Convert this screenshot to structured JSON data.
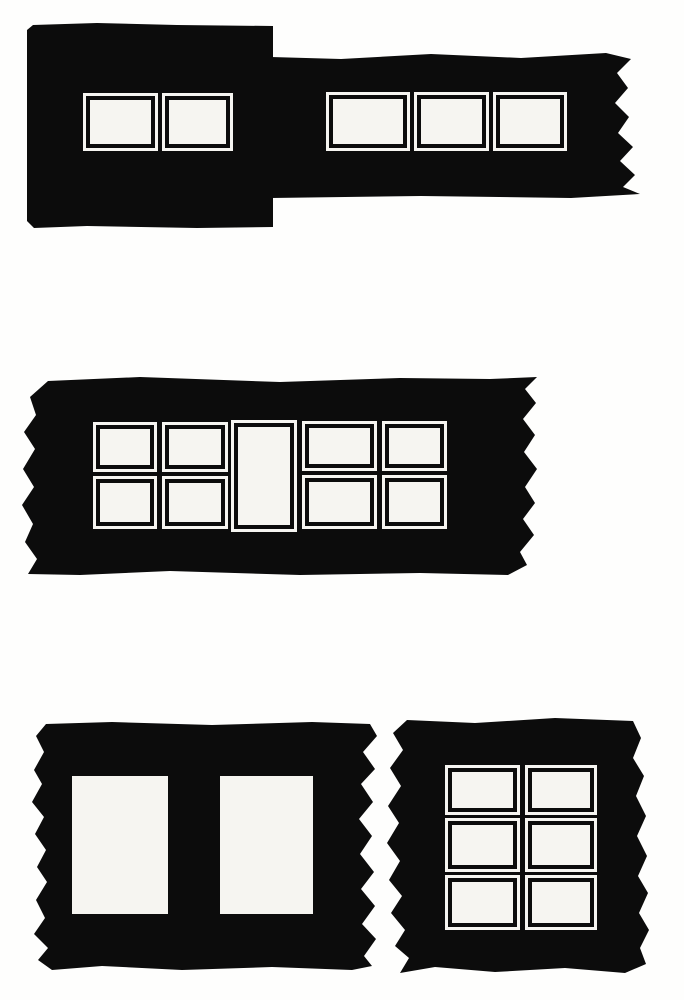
{
  "canvas": {
    "width": 684,
    "height": 1000
  },
  "colors": {
    "ink": "#0c0c0c",
    "background": "#fefefd",
    "window_fill": "#f6f5f1"
  },
  "blocks": [
    {
      "name": "filmstrip-top-left",
      "x": 27,
      "y": 23,
      "width": 246,
      "height": 205,
      "outline": [
        [
          0,
          7
        ],
        [
          6,
          2
        ],
        [
          70,
          0
        ],
        [
          150,
          2
        ],
        [
          246,
          3
        ],
        [
          246,
          204
        ],
        [
          170,
          205
        ],
        [
          60,
          203
        ],
        [
          7,
          205
        ],
        [
          0,
          198
        ]
      ],
      "windows": [
        {
          "type": "framed",
          "x": 56,
          "y": 70,
          "width": 75,
          "height": 58
        },
        {
          "type": "framed",
          "x": 135,
          "y": 70,
          "width": 71,
          "height": 58
        }
      ]
    },
    {
      "name": "filmstrip-top-right",
      "x": 271,
      "y": 53,
      "width": 369,
      "height": 145,
      "outline": [
        [
          0,
          4
        ],
        [
          70,
          6
        ],
        [
          160,
          1
        ],
        [
          250,
          5
        ],
        [
          335,
          0
        ],
        [
          360,
          6
        ],
        [
          346,
          20
        ],
        [
          357,
          35
        ],
        [
          344,
          50
        ],
        [
          358,
          64
        ],
        [
          347,
          80
        ],
        [
          362,
          94
        ],
        [
          349,
          108
        ],
        [
          364,
          122
        ],
        [
          352,
          134
        ],
        [
          369,
          141
        ],
        [
          300,
          145
        ],
        [
          150,
          143
        ],
        [
          0,
          145
        ]
      ],
      "windows": [
        {
          "type": "framed",
          "x": 55,
          "y": 39,
          "width": 84,
          "height": 59
        },
        {
          "type": "framed",
          "x": 143,
          "y": 39,
          "width": 75,
          "height": 59
        },
        {
          "type": "framed",
          "x": 222,
          "y": 39,
          "width": 74,
          "height": 59
        }
      ]
    },
    {
      "name": "filmstrip-middle",
      "x": 20,
      "y": 377,
      "width": 517,
      "height": 198,
      "outline": [
        [
          28,
          4
        ],
        [
          120,
          0
        ],
        [
          260,
          5
        ],
        [
          380,
          1
        ],
        [
          470,
          2
        ],
        [
          517,
          0
        ],
        [
          505,
          12
        ],
        [
          516,
          26
        ],
        [
          503,
          42
        ],
        [
          515,
          58
        ],
        [
          504,
          75
        ],
        [
          517,
          92
        ],
        [
          505,
          110
        ],
        [
          515,
          126
        ],
        [
          503,
          142
        ],
        [
          514,
          158
        ],
        [
          500,
          175
        ],
        [
          507,
          188
        ],
        [
          488,
          198
        ],
        [
          400,
          196
        ],
        [
          280,
          198
        ],
        [
          150,
          194
        ],
        [
          60,
          198
        ],
        [
          8,
          197
        ],
        [
          17,
          182
        ],
        [
          5,
          165
        ],
        [
          13,
          147
        ],
        [
          2,
          128
        ],
        [
          14,
          110
        ],
        [
          3,
          92
        ],
        [
          15,
          72
        ],
        [
          4,
          55
        ],
        [
          16,
          38
        ],
        [
          10,
          20
        ]
      ],
      "windows": [
        {
          "type": "framed",
          "x": 73,
          "y": 45,
          "width": 64,
          "height": 50
        },
        {
          "type": "framed",
          "x": 73,
          "y": 99,
          "width": 64,
          "height": 53
        },
        {
          "type": "framed",
          "x": 142,
          "y": 45,
          "width": 66,
          "height": 50
        },
        {
          "type": "framed",
          "x": 142,
          "y": 99,
          "width": 66,
          "height": 53
        },
        {
          "type": "framed",
          "x": 211,
          "y": 43,
          "width": 66,
          "height": 112
        },
        {
          "type": "framed",
          "x": 282,
          "y": 44,
          "width": 75,
          "height": 50
        },
        {
          "type": "framed",
          "x": 282,
          "y": 98,
          "width": 75,
          "height": 54
        },
        {
          "type": "framed",
          "x": 362,
          "y": 44,
          "width": 65,
          "height": 50
        },
        {
          "type": "framed",
          "x": 362,
          "y": 98,
          "width": 65,
          "height": 54
        }
      ]
    },
    {
      "name": "filmstrip-bottom-left",
      "x": 32,
      "y": 722,
      "width": 345,
      "height": 248,
      "outline": [
        [
          14,
          2
        ],
        [
          80,
          0
        ],
        [
          180,
          3
        ],
        [
          280,
          0
        ],
        [
          338,
          2
        ],
        [
          345,
          14
        ],
        [
          331,
          30
        ],
        [
          343,
          47
        ],
        [
          329,
          62
        ],
        [
          341,
          80
        ],
        [
          327,
          97
        ],
        [
          340,
          114
        ],
        [
          328,
          132
        ],
        [
          342,
          150
        ],
        [
          329,
          167
        ],
        [
          343,
          184
        ],
        [
          330,
          202
        ],
        [
          344,
          217
        ],
        [
          332,
          234
        ],
        [
          340,
          244
        ],
        [
          320,
          248
        ],
        [
          240,
          245
        ],
        [
          150,
          248
        ],
        [
          70,
          244
        ],
        [
          20,
          248
        ],
        [
          6,
          238
        ],
        [
          16,
          226
        ],
        [
          2,
          212
        ],
        [
          13,
          196
        ],
        [
          4,
          178
        ],
        [
          15,
          160
        ],
        [
          5,
          145
        ],
        [
          14,
          128
        ],
        [
          3,
          112
        ],
        [
          12,
          95
        ],
        [
          0,
          80
        ],
        [
          10,
          62
        ],
        [
          2,
          48
        ],
        [
          12,
          30
        ],
        [
          4,
          14
        ]
      ],
      "windows": [
        {
          "type": "plain",
          "x": 40,
          "y": 54,
          "width": 96,
          "height": 138
        },
        {
          "type": "plain",
          "x": 188,
          "y": 54,
          "width": 93,
          "height": 138
        }
      ]
    },
    {
      "name": "filmstrip-bottom-right",
      "x": 385,
      "y": 718,
      "width": 265,
      "height": 255,
      "outline": [
        [
          22,
          2
        ],
        [
          90,
          5
        ],
        [
          170,
          0
        ],
        [
          248,
          3
        ],
        [
          256,
          20
        ],
        [
          248,
          40
        ],
        [
          259,
          58
        ],
        [
          251,
          78
        ],
        [
          261,
          98
        ],
        [
          252,
          118
        ],
        [
          262,
          138
        ],
        [
          253,
          158
        ],
        [
          263,
          175
        ],
        [
          254,
          195
        ],
        [
          264,
          212
        ],
        [
          255,
          230
        ],
        [
          261,
          246
        ],
        [
          240,
          255
        ],
        [
          180,
          250
        ],
        [
          110,
          254
        ],
        [
          50,
          249
        ],
        [
          15,
          255
        ],
        [
          24,
          240
        ],
        [
          10,
          228
        ],
        [
          20,
          212
        ],
        [
          6,
          195
        ],
        [
          17,
          178
        ],
        [
          4,
          162
        ],
        [
          15,
          143
        ],
        [
          2,
          125
        ],
        [
          14,
          105
        ],
        [
          3,
          88
        ],
        [
          16,
          68
        ],
        [
          5,
          50
        ],
        [
          18,
          32
        ],
        [
          8,
          15
        ]
      ],
      "windows": [
        {
          "type": "framed",
          "x": 60,
          "y": 47,
          "width": 75,
          "height": 50
        },
        {
          "type": "framed",
          "x": 140,
          "y": 47,
          "width": 72,
          "height": 50
        },
        {
          "type": "framed",
          "x": 60,
          "y": 100,
          "width": 75,
          "height": 54
        },
        {
          "type": "framed",
          "x": 140,
          "y": 100,
          "width": 72,
          "height": 54
        },
        {
          "type": "framed",
          "x": 60,
          "y": 157,
          "width": 75,
          "height": 55
        },
        {
          "type": "framed",
          "x": 140,
          "y": 157,
          "width": 72,
          "height": 55
        }
      ]
    }
  ]
}
